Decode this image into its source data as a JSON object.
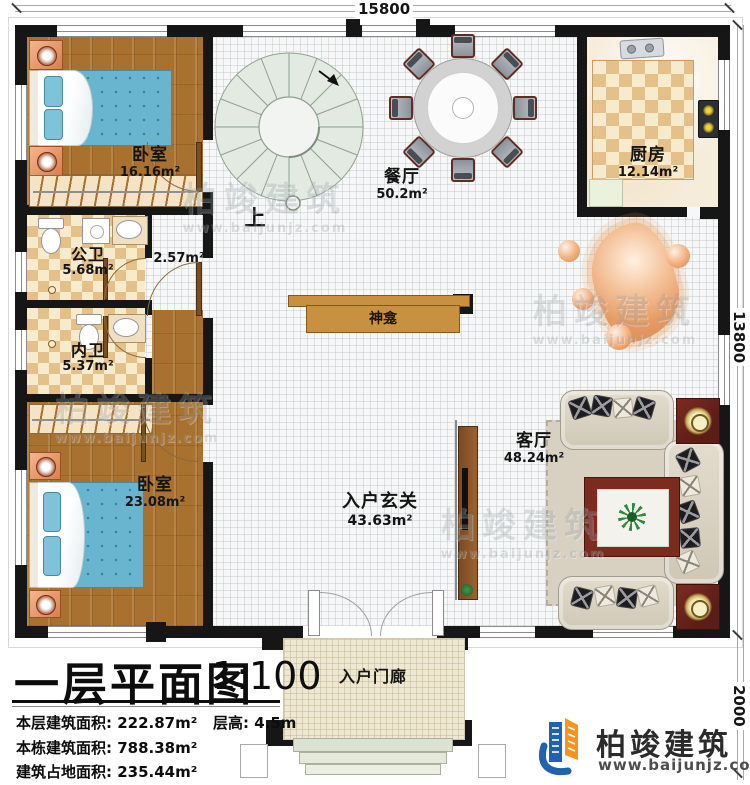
{
  "plan": {
    "title": "一层平面图",
    "scale": "1:100",
    "dims": {
      "top": "15800",
      "right": "13800",
      "porch_depth": "2000"
    },
    "labels": {
      "up": "上",
      "shrine": "神龛",
      "stair_area": "2.57m²"
    },
    "rooms": [
      {
        "name": "卧室",
        "area": "16.16m²"
      },
      {
        "name": "餐厅",
        "area": "50.2m²"
      },
      {
        "name": "厨房",
        "area": "12.14m²"
      },
      {
        "name": "公卫",
        "area": "5.68m²"
      },
      {
        "name": "内卫",
        "area": "5.37m²"
      },
      {
        "name": "卧室",
        "area": "23.08m²"
      },
      {
        "name": "客厅",
        "area": "48.24m²"
      },
      {
        "name": "入户玄关",
        "area": "43.63m²"
      },
      {
        "name": "入户门廊",
        "area": ""
      }
    ],
    "info": {
      "rows": [
        {
          "label": "本层建筑面积:",
          "value": "222.87m²"
        },
        {
          "label": "本栋建筑面积:",
          "value": "788.38m²"
        },
        {
          "label": "建筑占地面积:",
          "value": "235.44m²"
        }
      ],
      "floor_height_label": "层高:",
      "floor_height_value": "4.5m"
    },
    "brand": {
      "name": "柏竣建筑",
      "url": "www.baijunjz.com"
    },
    "watermark": {
      "name": "柏竣建筑",
      "url": "www.baijunjz.com"
    },
    "colors": {
      "wall": "#161616",
      "wood": "#a9712f",
      "tile": "#e5c088",
      "brand_blue": "#1e62b0",
      "brand_orange": "#f7941d"
    }
  }
}
